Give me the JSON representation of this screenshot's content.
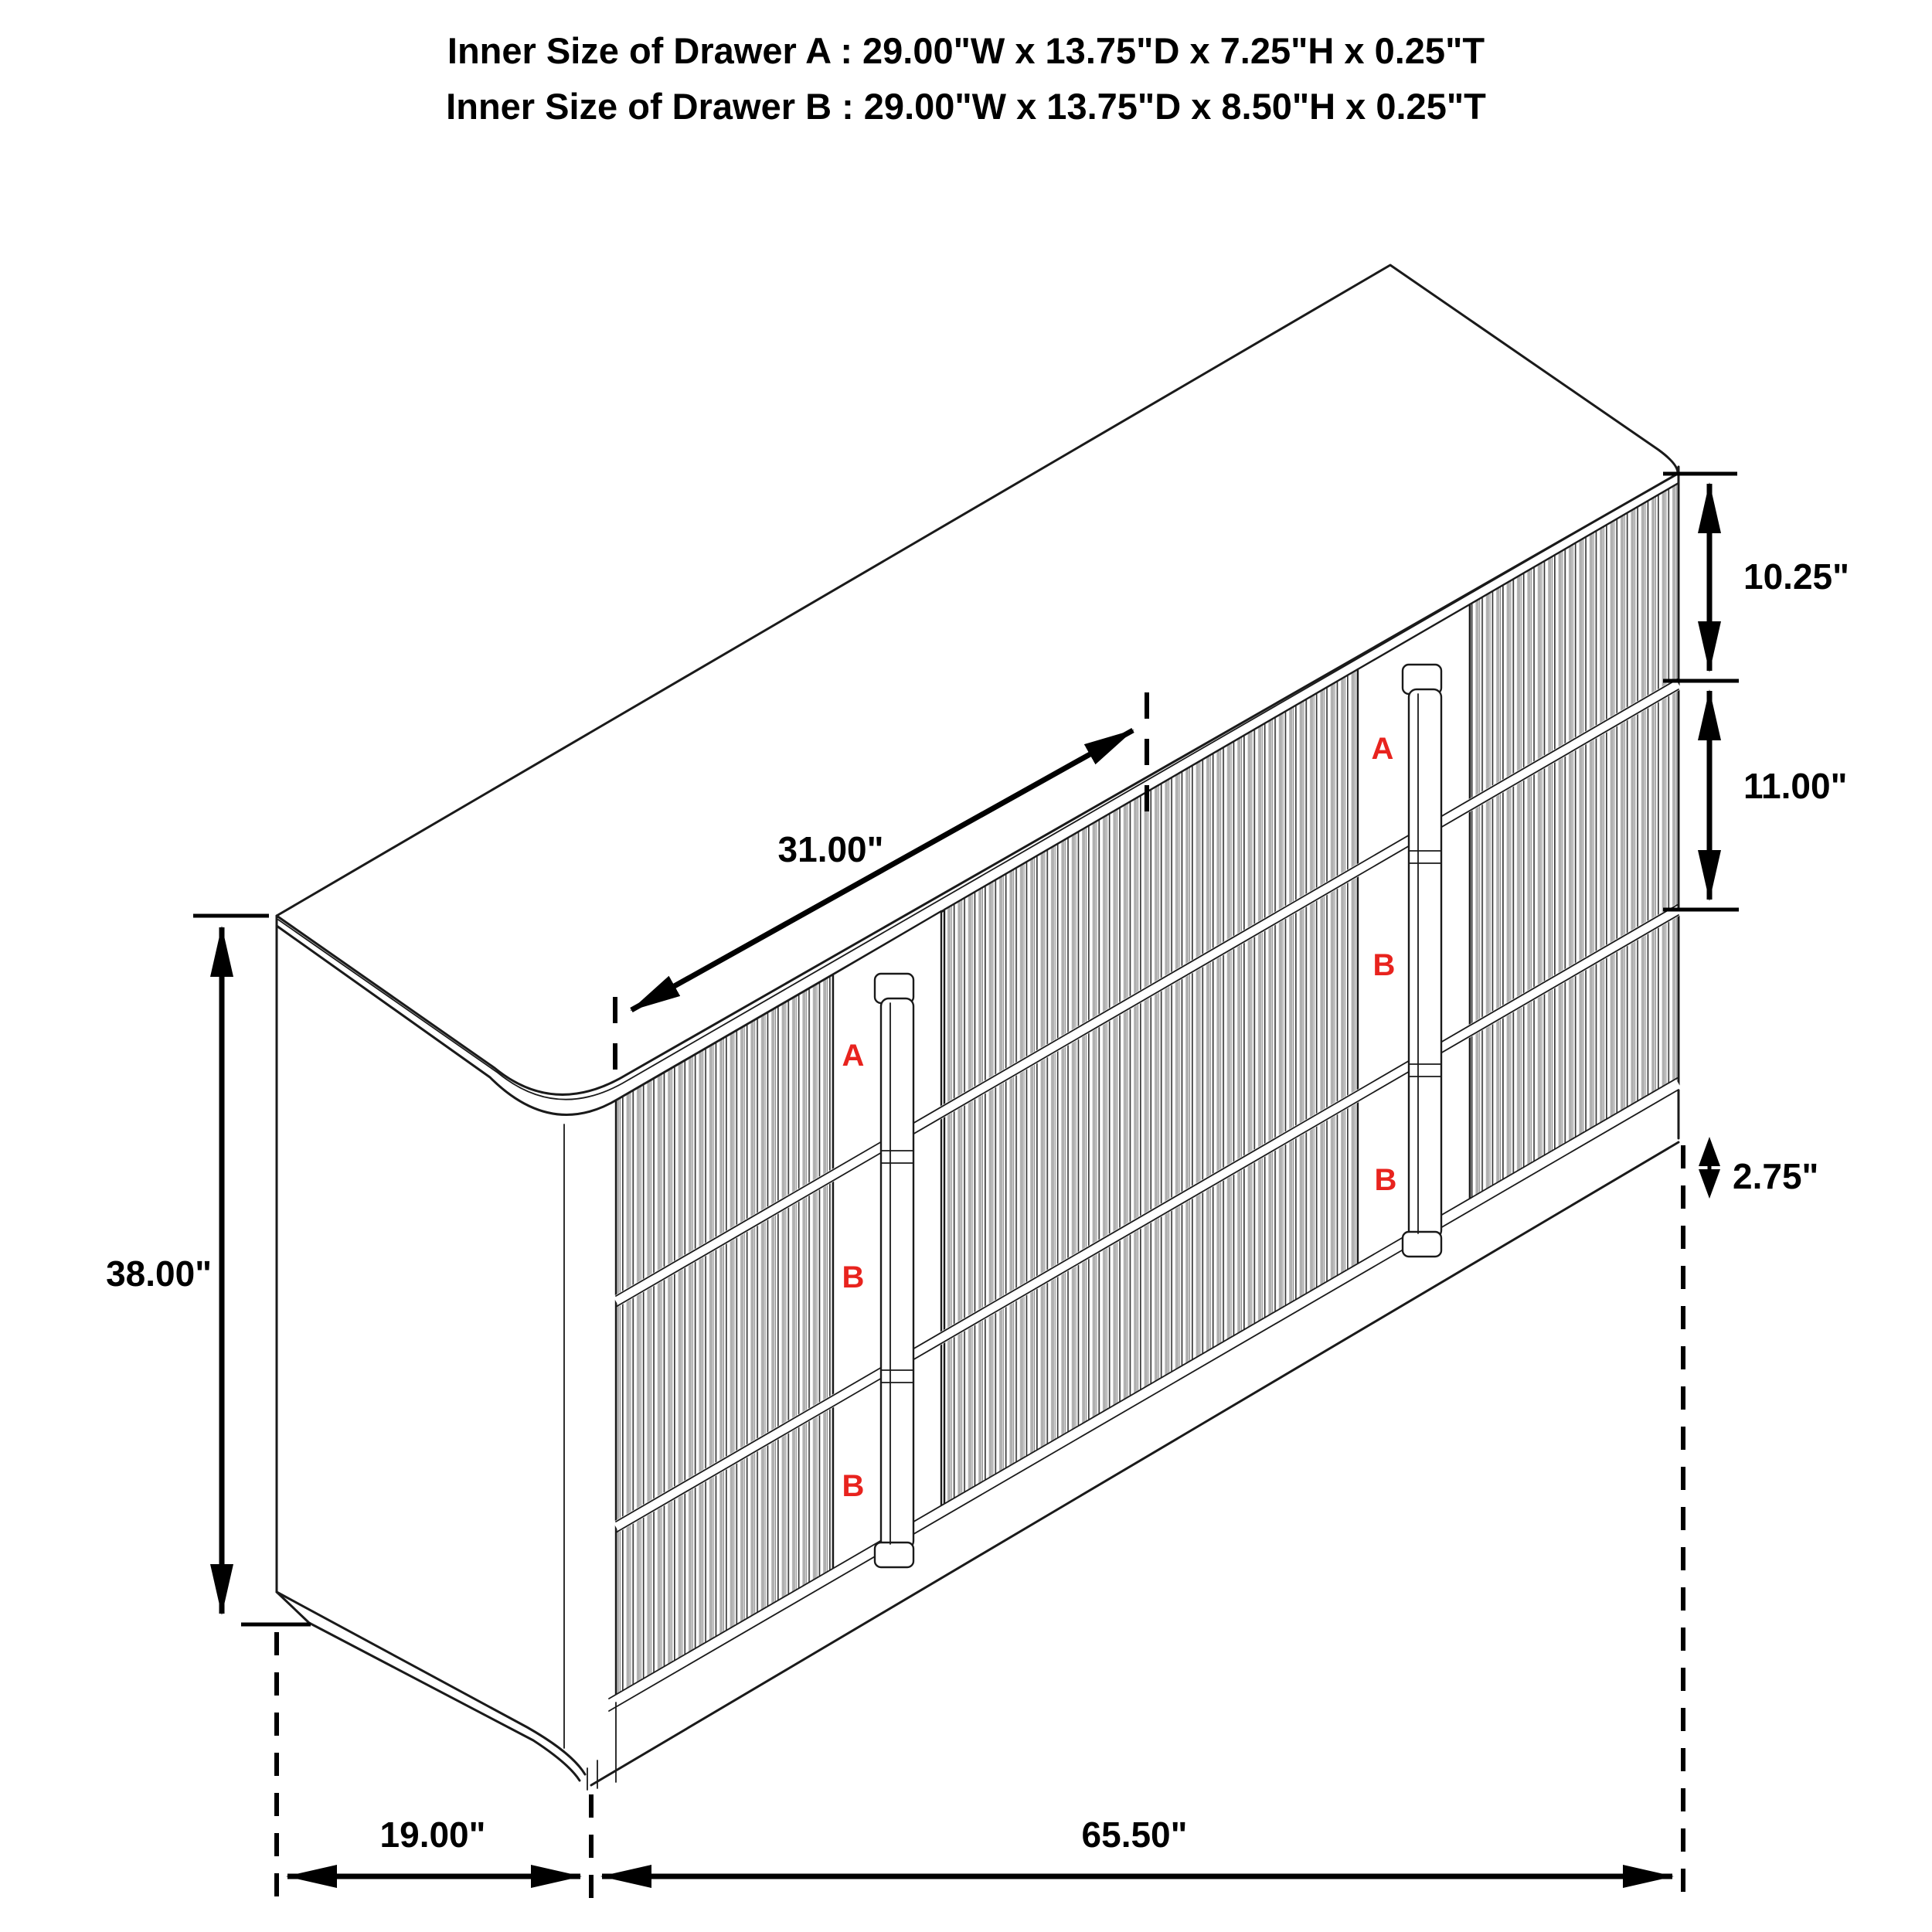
{
  "title": {
    "line_a": "Inner Size of Drawer A : 29.00\"W x 13.75\"D x 7.25\"H x 0.25\"T",
    "line_b": "Inner Size of Drawer B : 29.00\"W x 13.75\"D x 8.50\"H x 0.25\"T"
  },
  "dimensions": {
    "top_width": "31.00\"",
    "overall_height": "38.00\"",
    "depth": "19.00\"",
    "overall_width": "65.50\"",
    "upper_drawer_height": "10.25\"",
    "middle_drawer_height": "11.00\"",
    "base_height": "2.75\""
  },
  "drawer_labels": {
    "left_bank": [
      "A",
      "B",
      "B"
    ],
    "right_bank": [
      "A",
      "B",
      "B"
    ]
  },
  "colors": {
    "line": "#1a1a1a",
    "label_red": "#e8231e",
    "flute_shade": "#b0b0b0"
  }
}
